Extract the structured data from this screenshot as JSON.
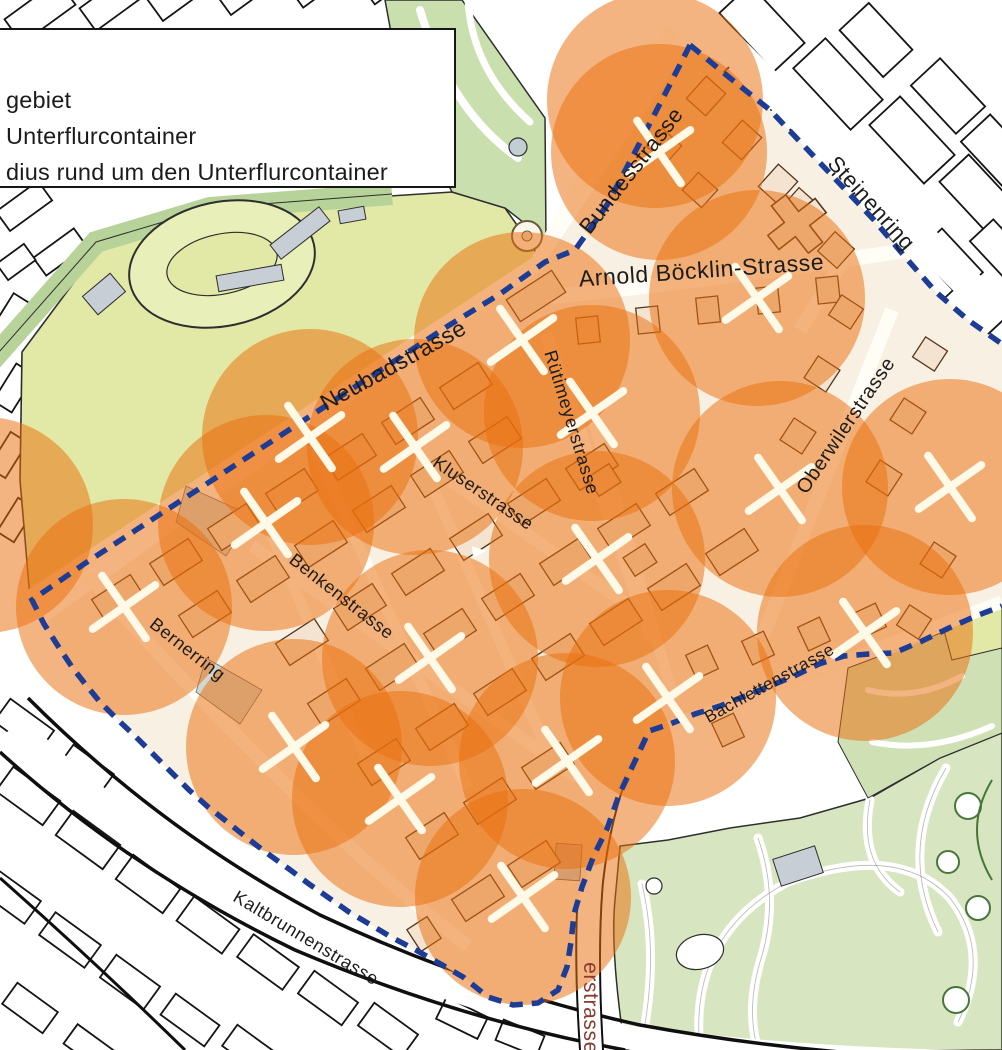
{
  "legend": {
    "items": [
      {
        "label": "gebiet"
      },
      {
        "label": "Unterflurcontainer"
      },
      {
        "label": "dius rund um den Unterflurcontainer"
      }
    ]
  },
  "map": {
    "street_labels": [
      {
        "name": "Bundesstrasse",
        "x": 637,
        "y": 175,
        "rot": -52,
        "size": 22,
        "color": "#1c1c1c"
      },
      {
        "name": "Steinenring",
        "x": 866,
        "y": 208,
        "rot": 48,
        "size": 22,
        "color": "#1c1c1c"
      },
      {
        "name": "Arnold Böcklin-Strasse",
        "x": 702,
        "y": 278,
        "rot": -4,
        "size": 23,
        "color": "#1c1c1c"
      },
      {
        "name": "Neubadstrasse",
        "x": 397,
        "y": 372,
        "rot": -29,
        "size": 23,
        "color": "#1c1c1c"
      },
      {
        "name": "Rütimeyerstrasse",
        "x": 566,
        "y": 424,
        "rot": 73,
        "size": 18,
        "color": "#1c1c1c"
      },
      {
        "name": "Kluserstrasse",
        "x": 480,
        "y": 498,
        "rot": 34,
        "size": 18,
        "color": "#1c1c1c"
      },
      {
        "name": "Oberwilerstrasse",
        "x": 851,
        "y": 429,
        "rot": -56,
        "size": 20,
        "color": "#1c1c1c"
      },
      {
        "name": "Benkenstrasse",
        "x": 338,
        "y": 601,
        "rot": 38,
        "size": 18,
        "color": "#1c1c1c"
      },
      {
        "name": "Bernerring",
        "x": 184,
        "y": 654,
        "rot": 38,
        "size": 18,
        "color": "#1c1c1c"
      },
      {
        "name": "Bachlettenstrasse",
        "x": 772,
        "y": 688,
        "rot": -29,
        "size": 17,
        "color": "#1c1c1c"
      },
      {
        "name": "Kaltbrunnenstrasse",
        "x": 303,
        "y": 943,
        "rot": 31,
        "size": 18,
        "color": "#1c1c1c"
      },
      {
        "name": "erstrasse",
        "x": 584,
        "y": 1008,
        "rot": 90,
        "size": 21,
        "color": "#8a3a2e"
      }
    ],
    "containers": [
      {
        "x": 659,
        "y": 152
      },
      {
        "x": 757,
        "y": 298
      },
      {
        "x": 522,
        "y": 340
      },
      {
        "x": 310,
        "y": 437
      },
      {
        "x": 415,
        "y": 447
      },
      {
        "x": 592,
        "y": 413
      },
      {
        "x": 780,
        "y": 489
      },
      {
        "x": 950,
        "y": 487
      },
      {
        "x": 597,
        "y": 559
      },
      {
        "x": 266,
        "y": 523
      },
      {
        "x": 124,
        "y": 607
      },
      {
        "x": 430,
        "y": 658
      },
      {
        "x": 865,
        "y": 633
      },
      {
        "x": 668,
        "y": 698
      },
      {
        "x": 294,
        "y": 747
      },
      {
        "x": 400,
        "y": 799
      },
      {
        "x": 567,
        "y": 761
      },
      {
        "x": 523,
        "y": 897
      }
    ],
    "extra_coverage_circles": [
      {
        "x": 655,
        "y": 100
      },
      {
        "x": -15,
        "y": 525
      }
    ],
    "coverage_radius_px": 108,
    "boundary": {
      "style": "dashed",
      "color": "#1C3C96",
      "segments": [
        [
          [
            690,
            45
          ],
          [
            730,
            78
          ],
          [
            770,
            110
          ],
          [
            806,
            148
          ],
          [
            840,
            184
          ],
          [
            874,
            220
          ],
          [
            906,
            258
          ],
          [
            936,
            292
          ],
          [
            968,
            320
          ],
          [
            1002,
            344
          ]
        ],
        [
          [
            690,
            45
          ],
          [
            664,
            96
          ],
          [
            636,
            150
          ],
          [
            607,
            205
          ],
          [
            575,
            250
          ],
          [
            545,
            262
          ],
          [
            500,
            294
          ],
          [
            448,
            326
          ],
          [
            396,
            360
          ],
          [
            344,
            394
          ],
          [
            292,
            428
          ],
          [
            240,
            462
          ],
          [
            188,
            496
          ],
          [
            136,
            530
          ],
          [
            84,
            564
          ],
          [
            32,
            600
          ],
          [
            44,
            624
          ],
          [
            58,
            646
          ],
          [
            72,
            667
          ],
          [
            86,
            685
          ],
          [
            100,
            702
          ],
          [
            118,
            720
          ],
          [
            136,
            737
          ],
          [
            153,
            754
          ],
          [
            171,
            772
          ],
          [
            189,
            790
          ],
          [
            207,
            806
          ],
          [
            226,
            821
          ],
          [
            246,
            837
          ],
          [
            264,
            851
          ],
          [
            289,
            869
          ],
          [
            309,
            884
          ],
          [
            329,
            898
          ],
          [
            349,
            912
          ],
          [
            371,
            925
          ],
          [
            391,
            937
          ],
          [
            414,
            949
          ],
          [
            437,
            962
          ],
          [
            463,
            977
          ],
          [
            488,
            997
          ],
          [
            513,
            1005
          ],
          [
            538,
            1003
          ],
          [
            558,
            990
          ],
          [
            567,
            967
          ],
          [
            571,
            942
          ],
          [
            574,
            914
          ],
          [
            582,
            887
          ],
          [
            594,
            855
          ],
          [
            607,
            829
          ],
          [
            619,
            795
          ],
          [
            635,
            761
          ],
          [
            649,
            731
          ],
          [
            670,
            724
          ],
          [
            695,
            714
          ],
          [
            720,
            706
          ],
          [
            745,
            696
          ],
          [
            770,
            686
          ],
          [
            794,
            676
          ],
          [
            819,
            664
          ],
          [
            844,
            656
          ],
          [
            869,
            654
          ],
          [
            894,
            653
          ],
          [
            922,
            641
          ],
          [
            949,
            628
          ],
          [
            976,
            616
          ],
          [
            1002,
            606
          ]
        ]
      ]
    },
    "colors": {
      "coverage_fill": "#E96F0E",
      "coverage_opacity": 0.52,
      "marker": "#FFF9E8",
      "boundary": "#1C3C96",
      "park_field": "#e2e8a6",
      "park_green": "#c9dfad",
      "band_green": "#b7d39a",
      "zoo_green": "#d7e5c0",
      "building_tan": "#f3e3d0",
      "building_outline": "#53361c",
      "outside_outline": "#151515"
    }
  }
}
